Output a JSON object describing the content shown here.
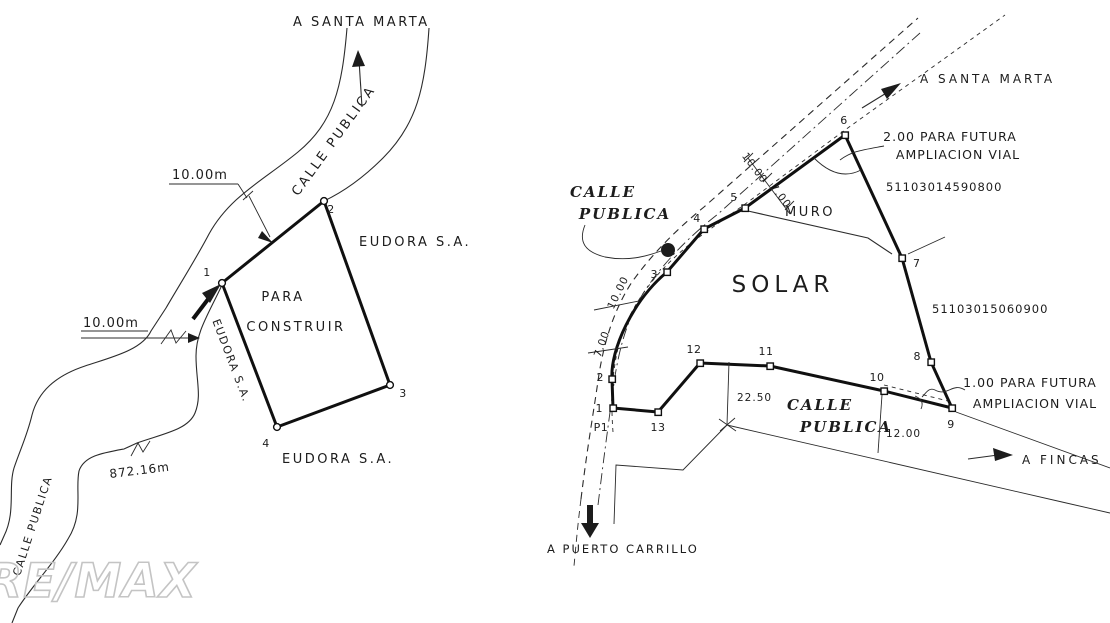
{
  "watermark": "RE/MAX",
  "left_plan": {
    "dest_top": "A SANTA MARTA",
    "road_upper": "CALLE PUBLICA",
    "road_lower": "CALLE PUBLICA",
    "dim_top": "10.00m",
    "dim_side": "10.00m",
    "length_note": "872.16m",
    "parcel_line1": "PARA",
    "parcel_line2": "CONSTRUIR",
    "owner_right": "EUDORA S.A.",
    "owner_bottom": "EUDORA S.A.",
    "owner_west": "EUDORA S.A.",
    "vertices": [
      "1",
      "2",
      "3",
      "4"
    ]
  },
  "right_plan": {
    "dest_top": "A SANTA MARTA",
    "dest_east": "A FINCAS",
    "dest_south": "A PUERTO CARRILLO",
    "road_left_line1": "CALLE",
    "road_left_line2": "PUBLICA",
    "road_bottom_line1": "CALLE",
    "road_bottom_line2": "PUBLICA",
    "parcel_label": "SOLAR",
    "wall_label": "MURO",
    "note_top_line1": "2.00 PARA FUTURA",
    "note_top_line2": "AMPLIACION VIAL",
    "note_east_line1": "1.00 PARA FUTURA",
    "note_east_line2": "AMPLIACION VIAL",
    "cadastral_top": "51103014590800",
    "cadastral_right": "51103015060900",
    "dim_road_ne_1": "10.00",
    "dim_road_ne_2": "7.00",
    "dim_road_w_1": "10.00",
    "dim_road_w_2": "7.00",
    "dim_bottom_1": "22.50",
    "dim_bottom_2": "12.00",
    "vertices": [
      "P1",
      "1",
      "2",
      "3",
      "4",
      "5",
      "6",
      "7",
      "8",
      "9",
      "10",
      "11",
      "12",
      "13"
    ]
  }
}
